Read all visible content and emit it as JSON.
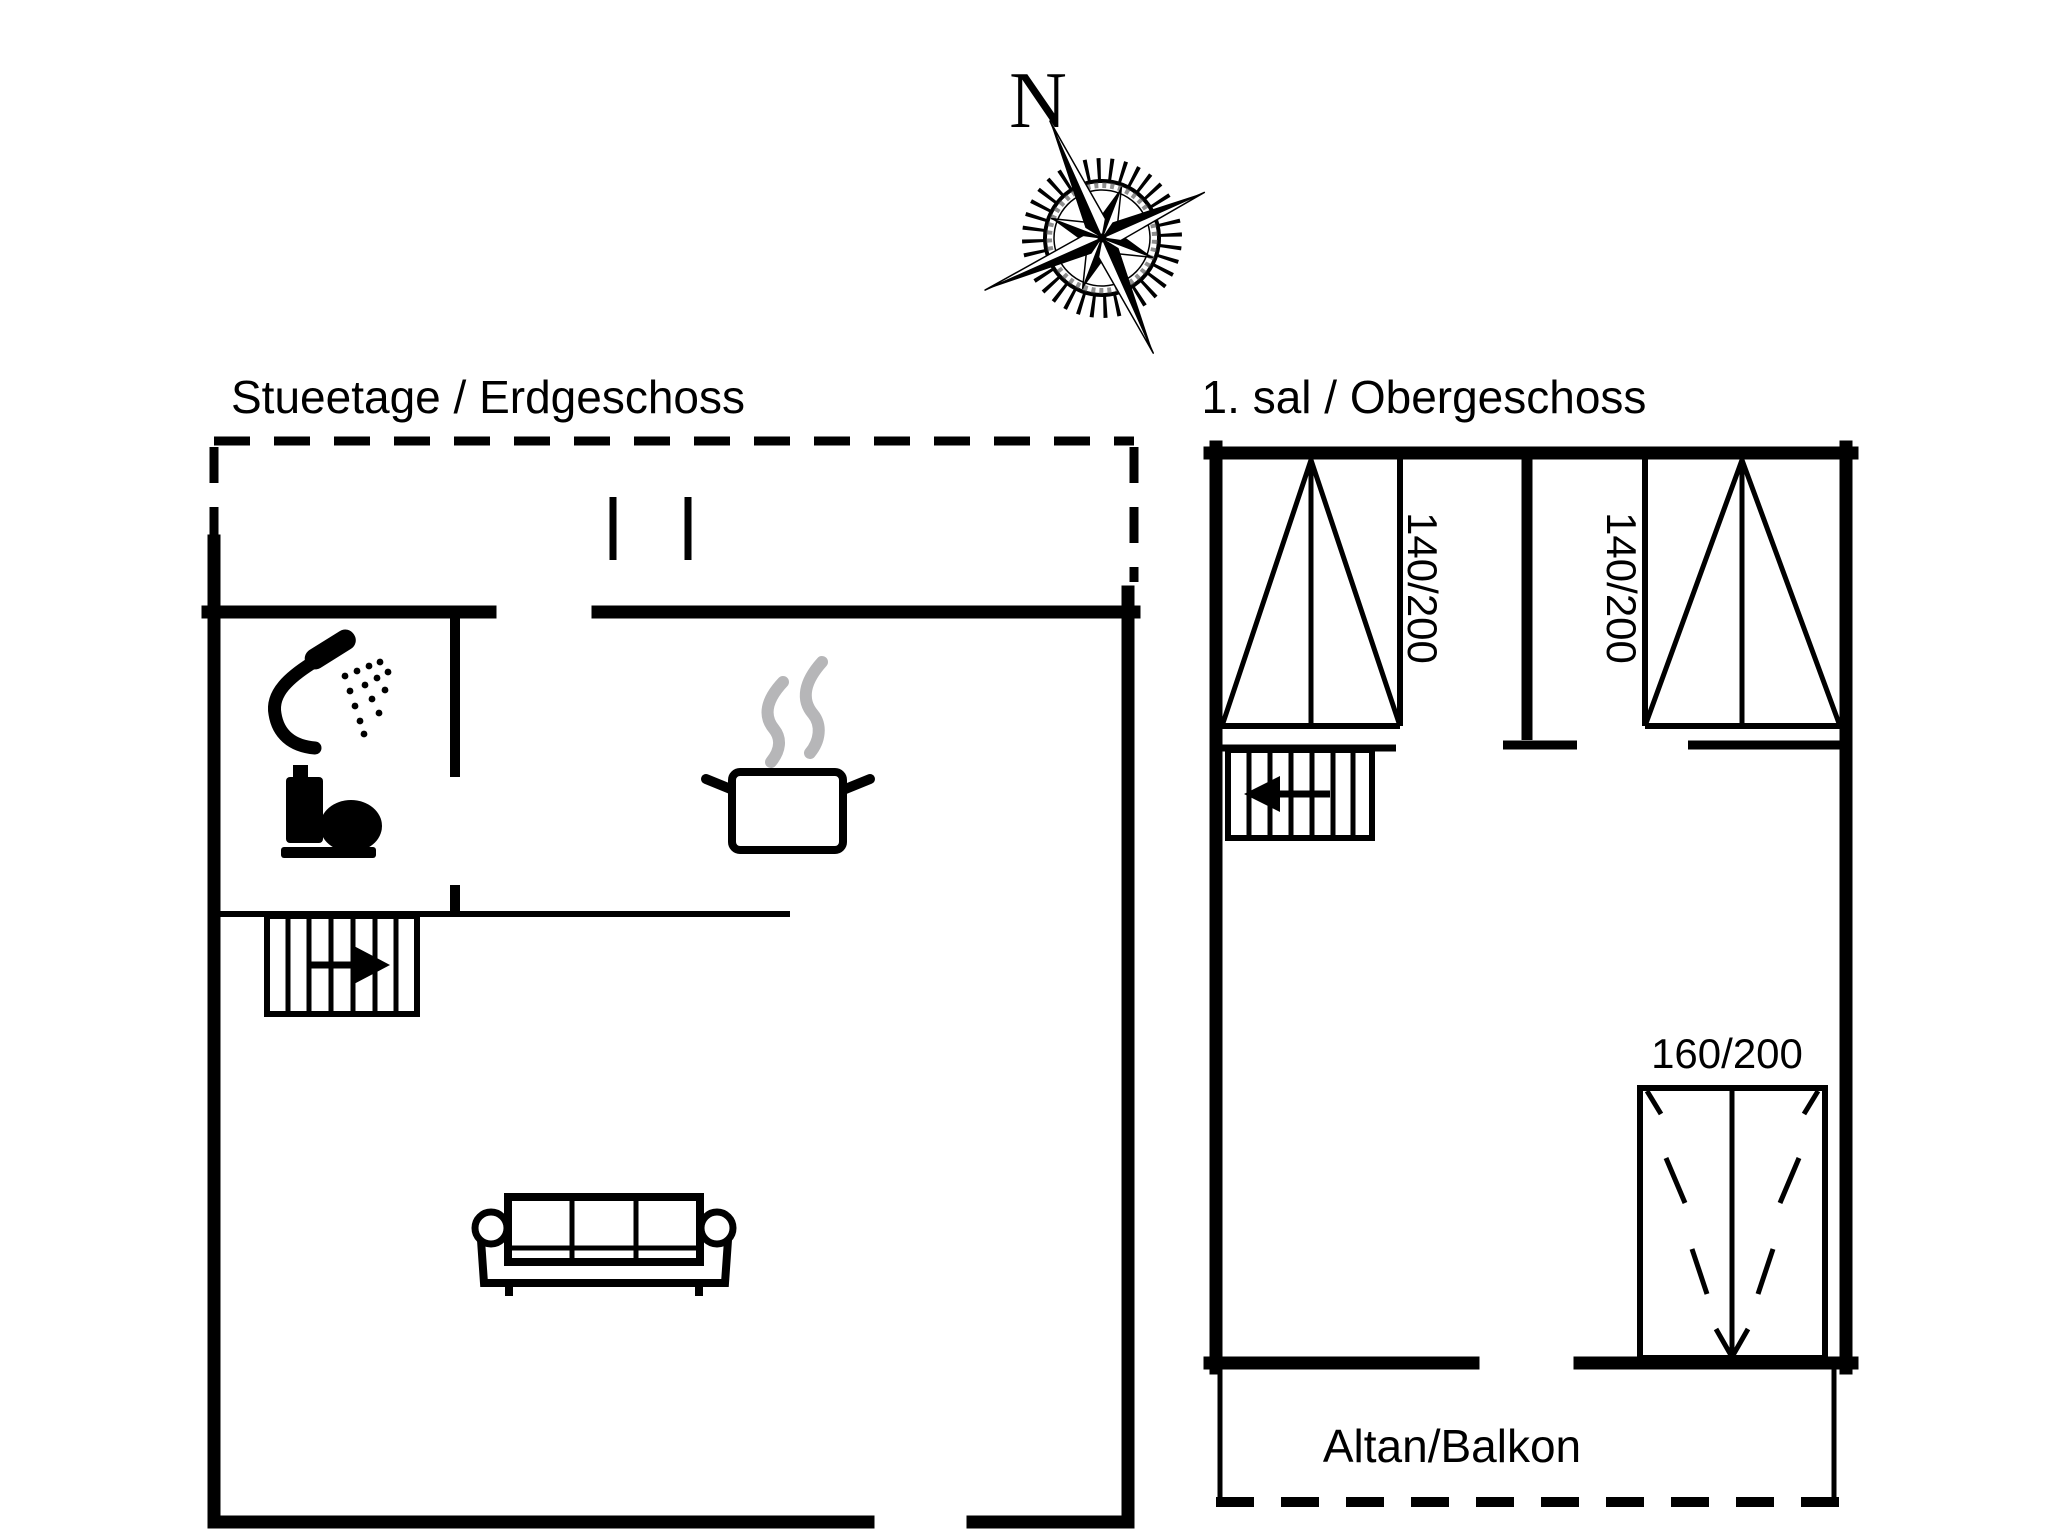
{
  "document": {
    "type": "holiday-home floor plan",
    "background_color": "#ffffff",
    "ink_color": "#000000",
    "steam_color": "#b6b6b8"
  },
  "compass": {
    "north_label": "N",
    "icon": "compass-rose-icon"
  },
  "floors": {
    "ground": {
      "title": "Stueetage / Erdgeschoss",
      "icons": {
        "shower": "shower-icon",
        "toilet": "toilet-icon",
        "stove": "steaming-pot-icon",
        "stairs": "stairs-up-icon",
        "sofa": "sofa-icon"
      }
    },
    "upper": {
      "title": "1. sal / Obergeschoss",
      "beds": [
        {
          "size": "140/200"
        },
        {
          "size": "140/200"
        }
      ],
      "large_bed": {
        "size": "160/200"
      },
      "balcony_label": "Altan/Balkon",
      "icons": {
        "stairs": "stairs-down-icon",
        "bed_left": "double-bed-icon",
        "bed_right": "double-bed-icon",
        "bed_large": "double-bed-160-icon"
      }
    }
  }
}
